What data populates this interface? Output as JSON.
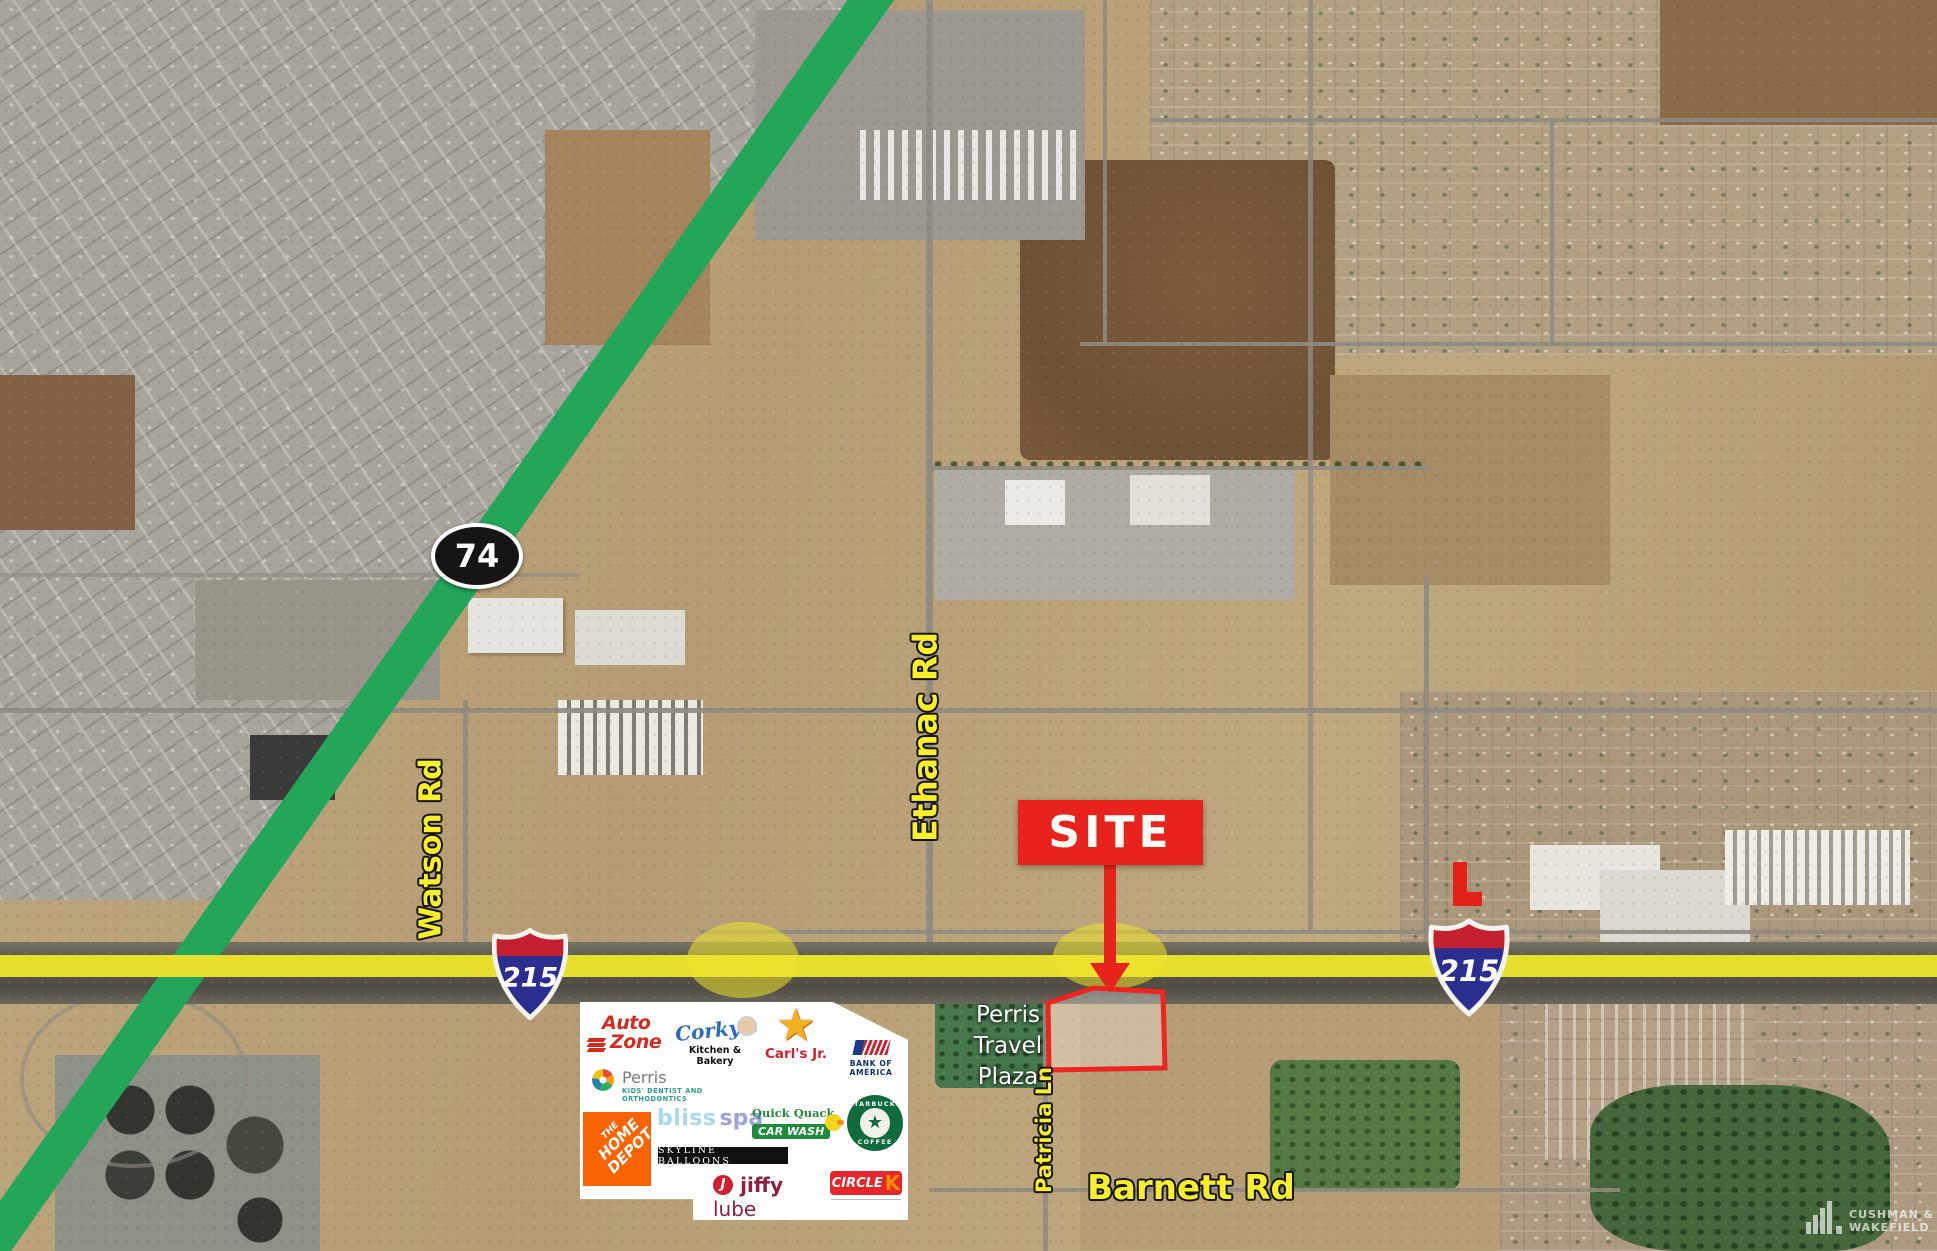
{
  "theme": {
    "route_green": "#23a55a",
    "freeway_yellow": "#e6df2d",
    "highlight_yellow": "#ede42c",
    "site_red": "#e8231d",
    "parcel_red": "#ee2420",
    "label_yellow": "#f7ef2a",
    "shield_blue": "#2a2f8f",
    "shield_red": "#c42031",
    "route74_black": "#161514"
  },
  "map": {
    "callout": {
      "site": "SITE"
    },
    "shields": {
      "route74": "74",
      "i215_left": "215",
      "i215_right": "215"
    },
    "road_labels": {
      "ethanac": "Ethanac Rd",
      "watson": "Watson Rd",
      "patricia": "Patricia Ln",
      "barnett": "Barnett Rd"
    },
    "place_labels": {
      "travel_plaza_line1": "Perris",
      "travel_plaza_line2": "Travel",
      "travel_plaza_line3": "Plaza"
    }
  },
  "tenant_panel": {
    "autozone_line1": "Auto",
    "autozone_line2": "Zone",
    "corkys_name": "Corky's",
    "corkys_tagline": "Kitchen & Bakery",
    "carls_star": "★",
    "carls_name": "Carl's Jr.",
    "boa_name": "BANK OF AMERICA",
    "perris_name": "Perris",
    "perris_tagline": "KIDS' DENTIST AND ORTHODONTICS",
    "homedepot_line1": "THE",
    "homedepot_line2": "HOME",
    "homedepot_line3": "DEPOT",
    "bliss_word1": "bliss",
    "bliss_word2": "spa",
    "quickquack_name": "Quick Quack",
    "quickquack_box": "CAR WASH",
    "starbucks_top": "STARBUCKS",
    "starbucks_bottom": "COFFEE",
    "skyline_name": "SKYLINE BALLOONS",
    "jiffy_initial": "J",
    "jiffy_word1": "jiffy",
    "jiffy_word2": "lube",
    "circlek_word": "CIRCLE",
    "circlek_k": "K"
  },
  "watermark": {
    "line1": "CUSHMAN &",
    "line2": "WAKEFIELD"
  }
}
